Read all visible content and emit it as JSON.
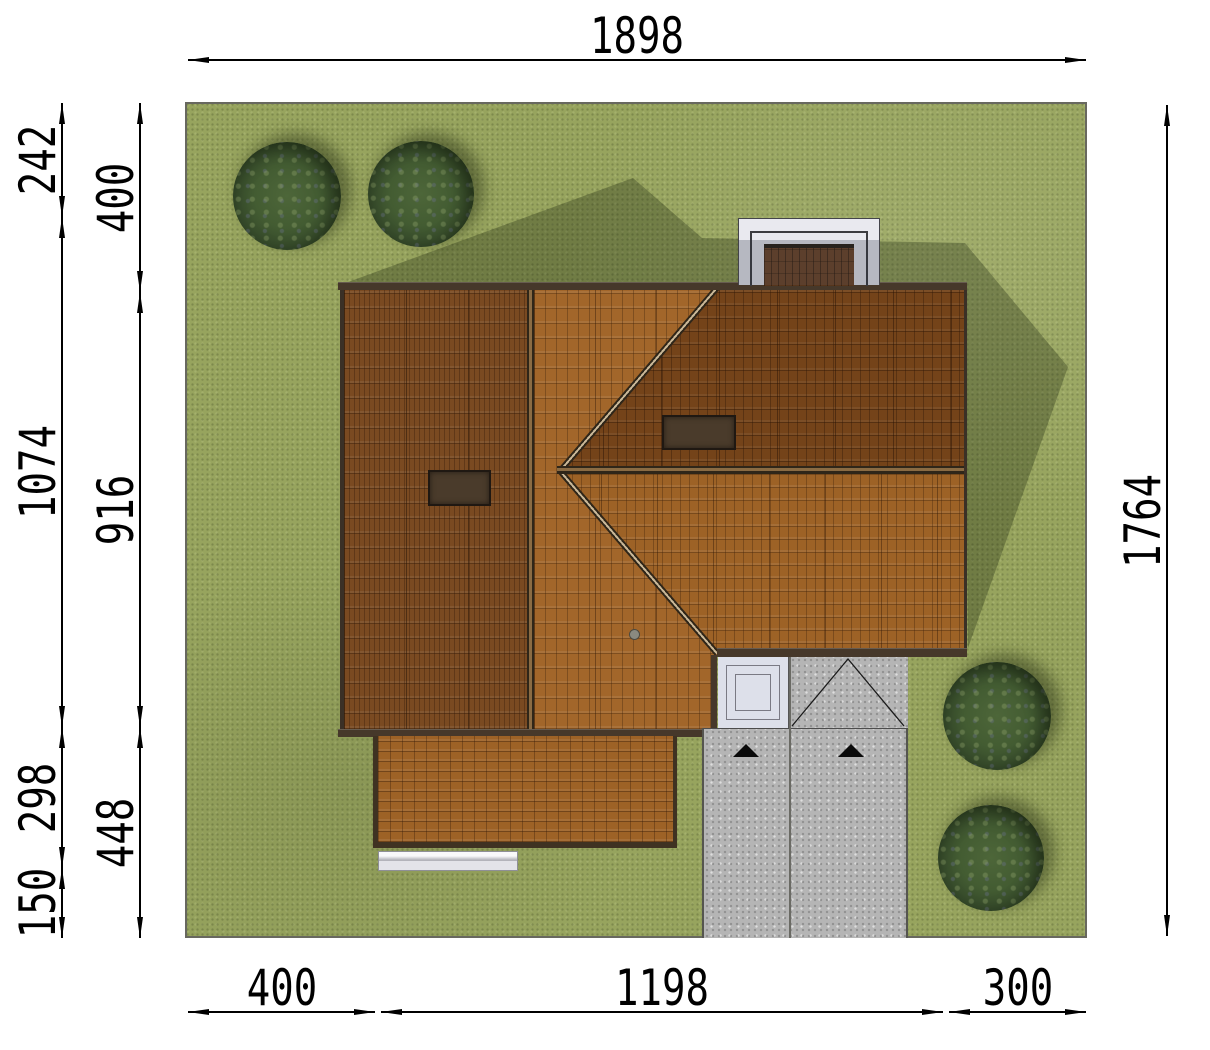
{
  "title": "House site plan (roof / plot view)",
  "palette": {
    "grass": "#97a45e",
    "grass_shadow": "rgba(24,32,9,0.30)",
    "roof_dark": "#7a4a21",
    "roof_mid": "#a2662a",
    "roof_light": "#9d6226",
    "roof_deep": "#744319",
    "eave": "#46382a",
    "porch_white": "#e9e9ef",
    "walkway": "#dde0ea",
    "driveway": "#b5b5b5",
    "tree": "#3f5730",
    "dimension": "#000000"
  },
  "scene": {
    "type": "site-plan-top-view",
    "elements": [
      "lawn",
      "house-roof",
      "garage-roof",
      "entrance-porch",
      "entrance-walkway",
      "driveway",
      "terrace",
      "trees",
      "house-shadow"
    ],
    "tree_count": 4,
    "garage_door_arrow_count": 2,
    "skylight_count": 2
  },
  "dimensions": {
    "chains": [
      {
        "id": "top",
        "axis": "h",
        "pos": 60,
        "label_offset": -24,
        "segments": [
          {
            "value": "1898",
            "from": 188,
            "to": 1086
          }
        ]
      },
      {
        "id": "bottom",
        "axis": "h",
        "pos": 1012,
        "label_offset": -24,
        "segments": [
          {
            "value": "400",
            "from": 188,
            "to": 375
          },
          {
            "value": "1198",
            "from": 381,
            "to": 943
          },
          {
            "value": "300",
            "from": 949,
            "to": 1086
          }
        ]
      },
      {
        "id": "left-outer",
        "axis": "v",
        "pos": 62,
        "label_offset": -24,
        "segments": [
          {
            "value": "242",
            "from": 103,
            "to": 217
          },
          {
            "value": "1074",
            "from": 217,
            "to": 727
          },
          {
            "value": "298",
            "from": 727,
            "to": 868
          },
          {
            "value": "150",
            "from": 868,
            "to": 938
          }
        ]
      },
      {
        "id": "left-inner",
        "axis": "v",
        "pos": 140,
        "label_offset": -24,
        "segments": [
          {
            "value": "400",
            "from": 103,
            "to": 292
          },
          {
            "value": "916",
            "from": 292,
            "to": 727
          },
          {
            "value": "448",
            "from": 727,
            "to": 938
          }
        ]
      },
      {
        "id": "right",
        "axis": "v",
        "pos": 1167,
        "label_offset": -24,
        "segments": [
          {
            "value": "1764",
            "from": 105,
            "to": 936
          }
        ]
      }
    ]
  }
}
